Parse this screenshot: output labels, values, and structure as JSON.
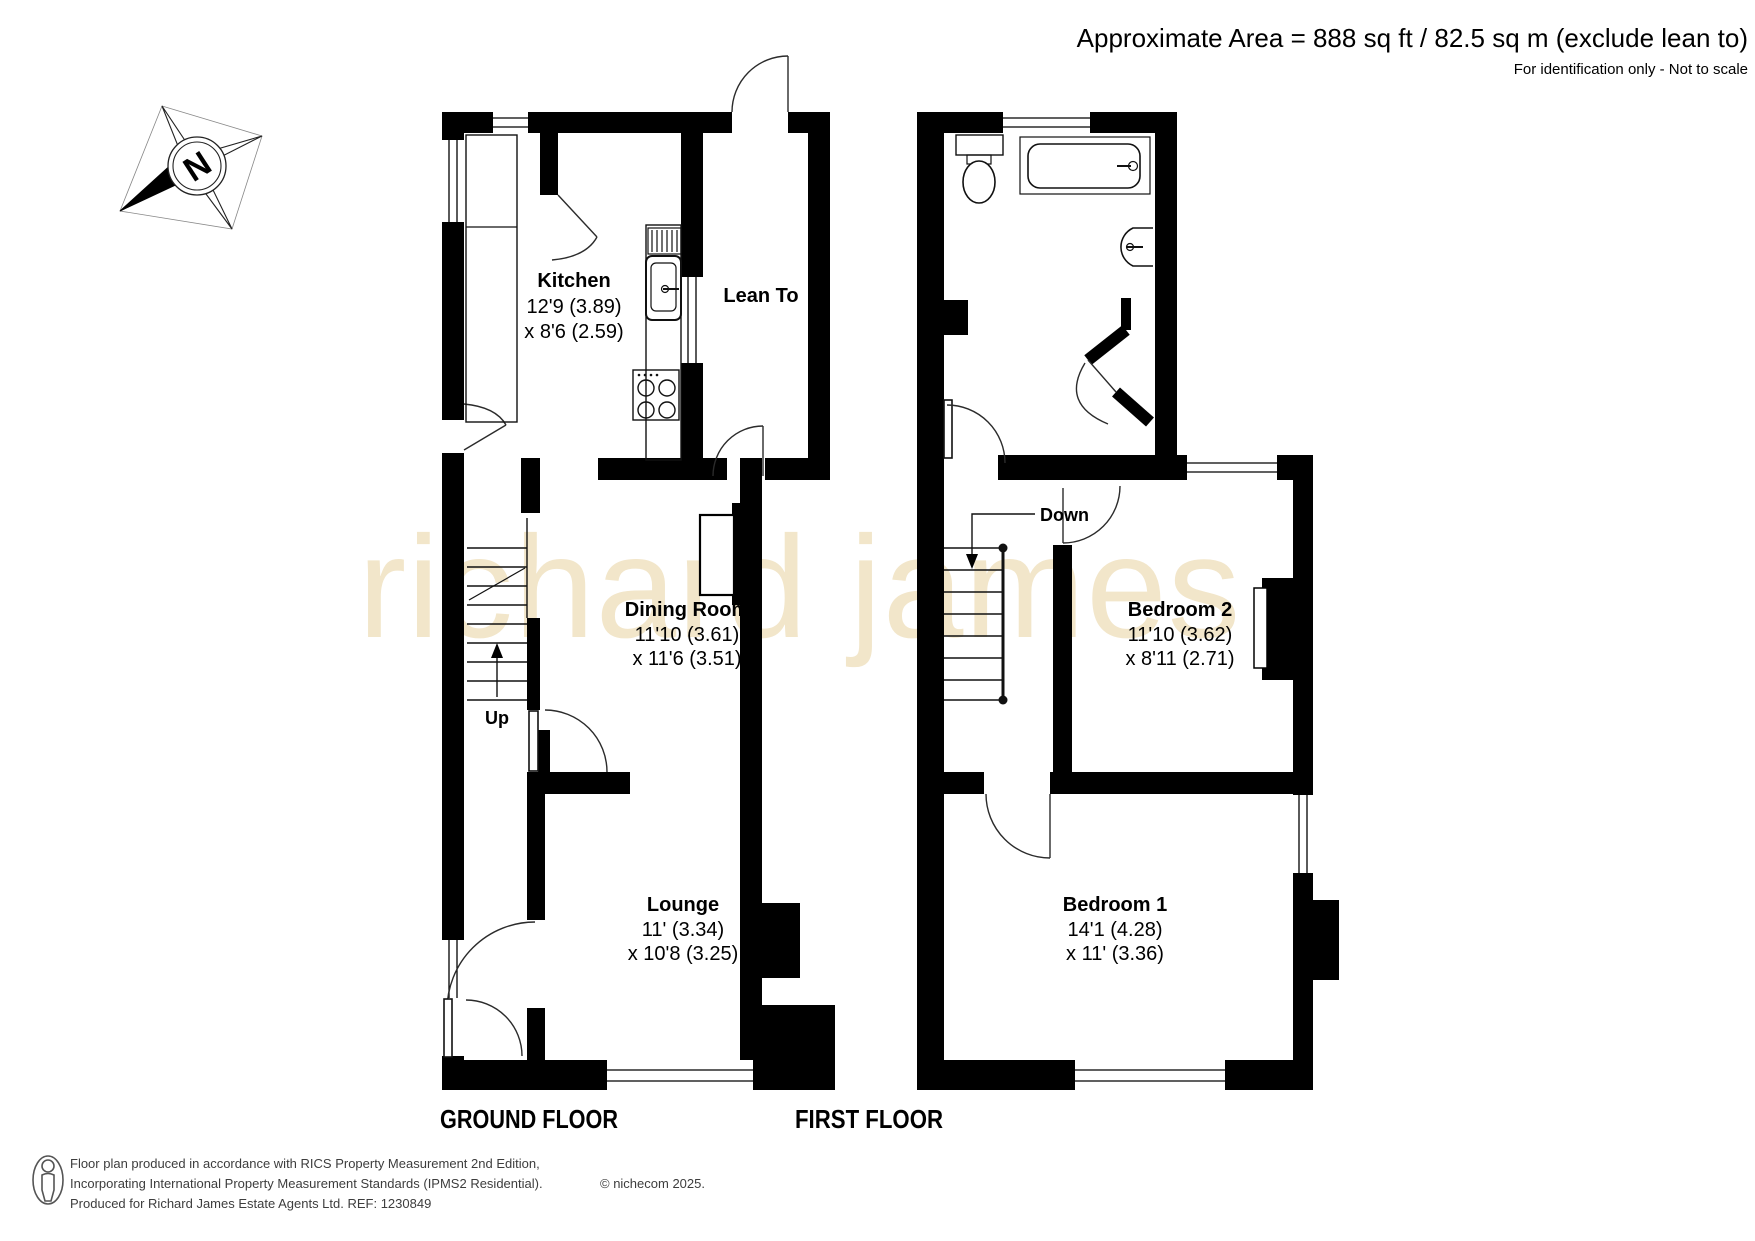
{
  "header": {
    "area_line": "Approximate Area = 888 sq ft / 82.5 sq m (exclude lean to)",
    "note": "For identification only - Not to scale"
  },
  "compass": {
    "label": "N"
  },
  "watermark": "richard james",
  "floors": [
    {
      "label": "GROUND FLOOR",
      "stair_label": "Up",
      "rooms": [
        {
          "name": "Kitchen",
          "dim1": "12'9 (3.89)",
          "dim2": "x 8'6 (2.59)"
        },
        {
          "name": "Lean To",
          "dim1": "",
          "dim2": ""
        },
        {
          "name": "Dining Room",
          "dim1": "11'10 (3.61)",
          "dim2": "x 11'6 (3.51)"
        },
        {
          "name": "Lounge",
          "dim1": "11' (3.34)",
          "dim2": "x 10'8 (3.25)"
        }
      ]
    },
    {
      "label": "FIRST FLOOR",
      "stair_label": "Down",
      "rooms": [
        {
          "name": "Bedroom 2",
          "dim1": "11'10 (3.62)",
          "dim2": "x 8'11 (2.71)"
        },
        {
          "name": "Bedroom 1",
          "dim1": "14'1 (4.28)",
          "dim2": "x 11' (3.36)"
        }
      ]
    }
  ],
  "footer": {
    "line1": "Floor plan produced in accordance with RICS Property Measurement 2nd Edition,",
    "line2": "Incorporating International Property Measurement Standards (IPMS2 Residential).",
    "copyright": "© nichecom 2025.",
    "line3": "Produced for Richard James Estate Agents Ltd.   REF: 1230849"
  },
  "colors": {
    "wall": "#000000",
    "watermark": "#f2e6ca",
    "footer_text": "#3d3d3d"
  }
}
